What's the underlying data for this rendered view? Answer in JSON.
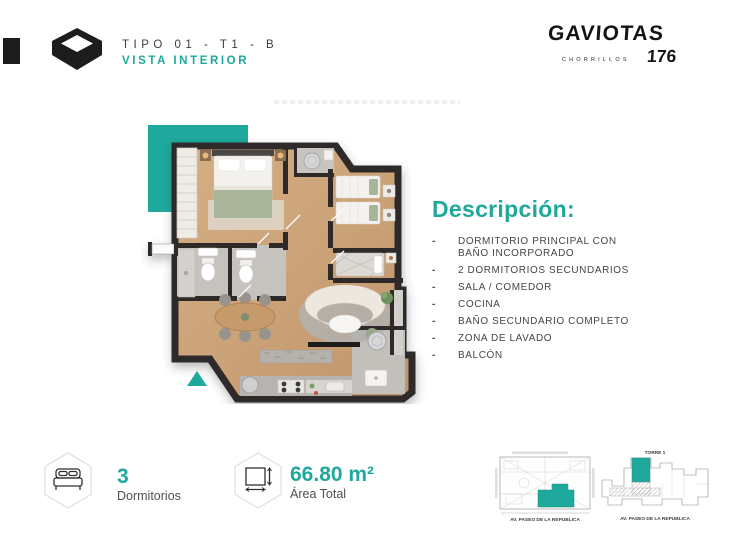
{
  "accent_color": "#1FA89C",
  "header": {
    "type_label": "TIPO 01 - T1 - B",
    "view_label": "VISTA INTERIOR",
    "brand": {
      "name": "GAVIOTAS",
      "district": "CHORRILLOS",
      "number": "176"
    }
  },
  "description": {
    "title": "Descripción:",
    "bullet": "-",
    "items": [
      "DORMITORIO PRINCIPAL CON BAÑO INCORPORADO",
      "2 DORMITORIOS SECUNDARIOS",
      "SALA / COMEDOR",
      "COCINA",
      "BAÑO SECUNDARIO COMPLETO",
      "ZONA DE LAVADO",
      "BALCÓN"
    ]
  },
  "stats": [
    {
      "icon": "bed-icon",
      "value": "3",
      "label": "Dormitorios"
    },
    {
      "icon": "area-icon",
      "value": "66.80 m²",
      "label": "Área Total"
    }
  ],
  "minimaps": [
    {
      "caption": "AV. PASEO DE LA REPUBLICA"
    },
    {
      "title": "TORRE 1",
      "caption": "AV. PASEO DE LA REPUBLICA"
    }
  ]
}
